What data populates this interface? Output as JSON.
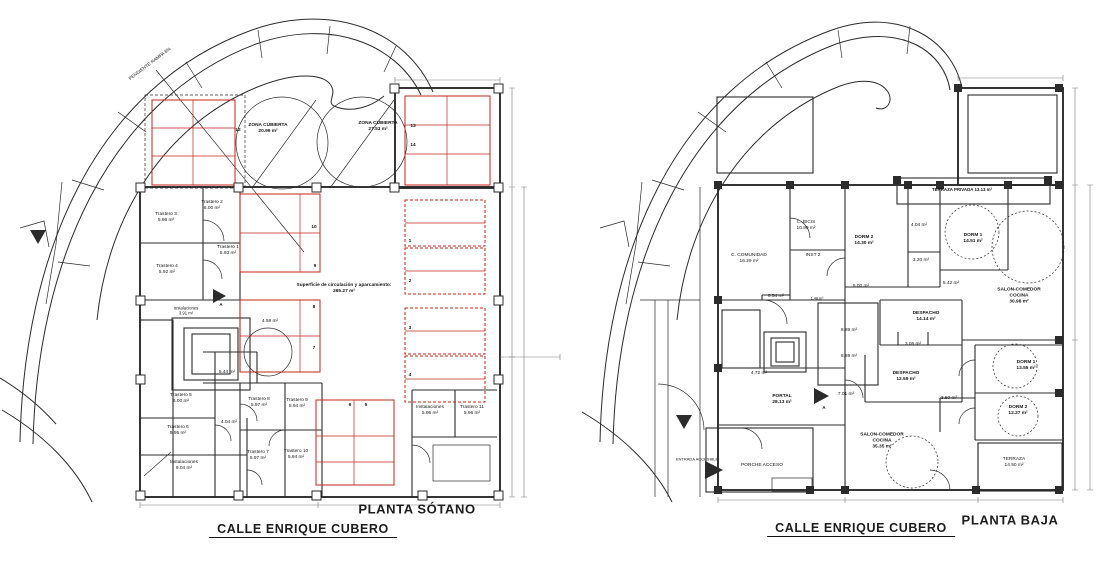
{
  "drawing": {
    "street_label": "CALLE ENRIQUE CUBERO",
    "colors": {
      "wall": "#2b2b2b",
      "parking": "#c4251c",
      "dim": "#7a7a7a",
      "hatch": "#9b9b9b"
    },
    "plans": {
      "sotano": {
        "title": "PLANTA SÓTANO",
        "labels": [
          {
            "lines": [
              "PENDIENTE RAMPA 8%"
            ],
            "x": 150,
            "y": 64,
            "rot": -37,
            "s": 4.6
          },
          {
            "lines": [
              "ZONA CUBIERTA",
              "20.99 m²"
            ],
            "x": 268,
            "y": 129,
            "b": 1
          },
          {
            "lines": [
              "ZONA CUBIERTA",
              "27.53 m²"
            ],
            "x": 378,
            "y": 127,
            "b": 1
          },
          {
            "lines": [
              "12"
            ],
            "x": 238,
            "y": 131,
            "b": 1
          },
          {
            "lines": [
              "13"
            ],
            "x": 413,
            "y": 127,
            "b": 1
          },
          {
            "lines": [
              "14"
            ],
            "x": 413,
            "y": 146,
            "b": 1
          },
          {
            "lines": [
              "Trastero 2",
              "6.00 m²"
            ],
            "x": 212,
            "y": 206
          },
          {
            "lines": [
              "Trastero 3",
              "5.96 m²"
            ],
            "x": 166,
            "y": 218
          },
          {
            "lines": [
              "Trastero 1",
              "5.93 m²"
            ],
            "x": 228,
            "y": 251
          },
          {
            "lines": [
              "Trastero 4",
              "5.92 m²"
            ],
            "x": 167,
            "y": 270
          },
          {
            "lines": [
              "10"
            ],
            "x": 314,
            "y": 228,
            "b": 1
          },
          {
            "lines": [
              "9"
            ],
            "x": 315,
            "y": 267,
            "b": 1
          },
          {
            "lines": [
              "Superficie de circulación y aparcamiento:",
              "265.27 m²"
            ],
            "x": 344,
            "y": 289,
            "b": 1
          },
          {
            "lines": [
              "1"
            ],
            "x": 410,
            "y": 242,
            "b": 1
          },
          {
            "lines": [
              "2"
            ],
            "x": 410,
            "y": 282,
            "b": 1
          },
          {
            "lines": [
              "3"
            ],
            "x": 410,
            "y": 329,
            "b": 1
          },
          {
            "lines": [
              "4"
            ],
            "x": 410,
            "y": 376,
            "b": 1
          },
          {
            "lines": [
              "Instalaciones",
              "3.91 m²"
            ],
            "x": 186,
            "y": 311,
            "s": 4.2
          },
          {
            "lines": [
              "4.58 m²"
            ],
            "x": 270,
            "y": 322
          },
          {
            "lines": [
              "8"
            ],
            "x": 314,
            "y": 308,
            "b": 1
          },
          {
            "lines": [
              "7"
            ],
            "x": 314,
            "y": 349,
            "b": 1
          },
          {
            "lines": [
              "5.44 m²"
            ],
            "x": 227,
            "y": 373
          },
          {
            "lines": [
              "Trastero 5",
              "6.00 m²"
            ],
            "x": 181,
            "y": 399
          },
          {
            "lines": [
              "Trastero 8",
              "5.97 m²"
            ],
            "x": 259,
            "y": 403
          },
          {
            "lines": [
              "Trastero 9",
              "5.94 m²"
            ],
            "x": 297,
            "y": 404
          },
          {
            "lines": [
              "Trastero 6",
              "5.95 m²"
            ],
            "x": 178,
            "y": 431
          },
          {
            "lines": [
              "4.04 m²"
            ],
            "x": 229,
            "y": 423
          },
          {
            "lines": [
              "Trastero 7",
              "5.97 m²"
            ],
            "x": 258,
            "y": 456
          },
          {
            "lines": [
              "Trastero 10",
              "5.94 m²"
            ],
            "x": 296,
            "y": 455
          },
          {
            "lines": [
              "Instalaciones",
              "9.04 m²"
            ],
            "x": 184,
            "y": 466
          },
          {
            "lines": [
              "6"
            ],
            "x": 350,
            "y": 406,
            "b": 1
          },
          {
            "lines": [
              "5"
            ],
            "x": 366,
            "y": 406,
            "b": 1
          },
          {
            "lines": [
              "Instalaciones",
              "5.96 m²"
            ],
            "x": 430,
            "y": 411
          },
          {
            "lines": [
              "Trastero 11",
              "5.96 m²"
            ],
            "x": 472,
            "y": 411
          },
          {
            "lines": [
              "A"
            ],
            "x": 221,
            "y": 305,
            "s": 4.4,
            "b": 1
          }
        ]
      },
      "baja": {
        "title": "PLANTA BAJA",
        "labels": [
          {
            "lines": [
              "TERRAZA PRIVADA  13.13 m²"
            ],
            "x": 962,
            "y": 190,
            "b": 1,
            "s": 4.4
          },
          {
            "lines": [
              "C. BICIS",
              "10.99 m²"
            ],
            "x": 806,
            "y": 226
          },
          {
            "lines": [
              "DORM 2",
              "14.30 m²"
            ],
            "x": 864,
            "y": 241,
            "b": 1
          },
          {
            "lines": [
              "INST 2"
            ],
            "x": 813,
            "y": 256
          },
          {
            "lines": [
              "C. COMUNIDAD",
              "16.29 m²"
            ],
            "x": 749,
            "y": 259
          },
          {
            "lines": [
              "4.04 m²"
            ],
            "x": 919,
            "y": 226
          },
          {
            "lines": [
              "3.20 m²"
            ],
            "x": 921,
            "y": 261
          },
          {
            "lines": [
              "DORM 1",
              "14.51 m²"
            ],
            "x": 973,
            "y": 239,
            "b": 1
          },
          {
            "lines": [
              "SALON-COMEDOR",
              "COCINA",
              "30.98 m²"
            ],
            "x": 1019,
            "y": 297,
            "b": 1
          },
          {
            "lines": [
              "5.42 m²"
            ],
            "x": 951,
            "y": 284
          },
          {
            "lines": [
              "0.54 m²"
            ],
            "x": 776,
            "y": 297
          },
          {
            "lines": [
              "5.00 m²"
            ],
            "x": 861,
            "y": 287
          },
          {
            "lines": [
              "1.48 m²"
            ],
            "x": 817,
            "y": 299,
            "s": 3.8
          },
          {
            "lines": [
              "DESPACHO",
              "14.14 m²"
            ],
            "x": 926,
            "y": 317,
            "b": 1
          },
          {
            "lines": [
              "8.89 m²"
            ],
            "x": 849,
            "y": 331
          },
          {
            "lines": [
              "8.89 m²"
            ],
            "x": 849,
            "y": 357
          },
          {
            "lines": [
              "3.05 m²"
            ],
            "x": 913,
            "y": 345
          },
          {
            "lines": [
              "DESPACHO",
              "12.59 m²"
            ],
            "x": 906,
            "y": 377,
            "b": 1
          },
          {
            "lines": [
              "DORM 1",
              "13.55 m²"
            ],
            "x": 1026,
            "y": 366,
            "b": 1
          },
          {
            "lines": [
              "3.50 m²"
            ],
            "x": 949,
            "y": 399
          },
          {
            "lines": [
              "DORM 2",
              "12.27 m²"
            ],
            "x": 1018,
            "y": 411,
            "b": 1
          },
          {
            "lines": [
              "PORTAL",
              "28.13 m²"
            ],
            "x": 782,
            "y": 400,
            "b": 1
          },
          {
            "lines": [
              "7.01 m²"
            ],
            "x": 846,
            "y": 395
          },
          {
            "lines": [
              "4.72 m²"
            ],
            "x": 759,
            "y": 374
          },
          {
            "lines": [
              "SALON-COMEDOR",
              "COCINA",
              "35.35 m²"
            ],
            "x": 882,
            "y": 442,
            "b": 1
          },
          {
            "lines": [
              "TERRAZA",
              "14.50 m²"
            ],
            "x": 1014,
            "y": 463
          },
          {
            "lines": [
              "PORCHE ACCESO"
            ],
            "x": 762,
            "y": 466
          },
          {
            "lines": [
              "ENTRADA ACCESIBLE"
            ],
            "x": 697,
            "y": 459,
            "s": 4
          },
          {
            "lines": [
              "A"
            ],
            "x": 824,
            "y": 408,
            "s": 4.4,
            "b": 1
          }
        ]
      }
    }
  }
}
